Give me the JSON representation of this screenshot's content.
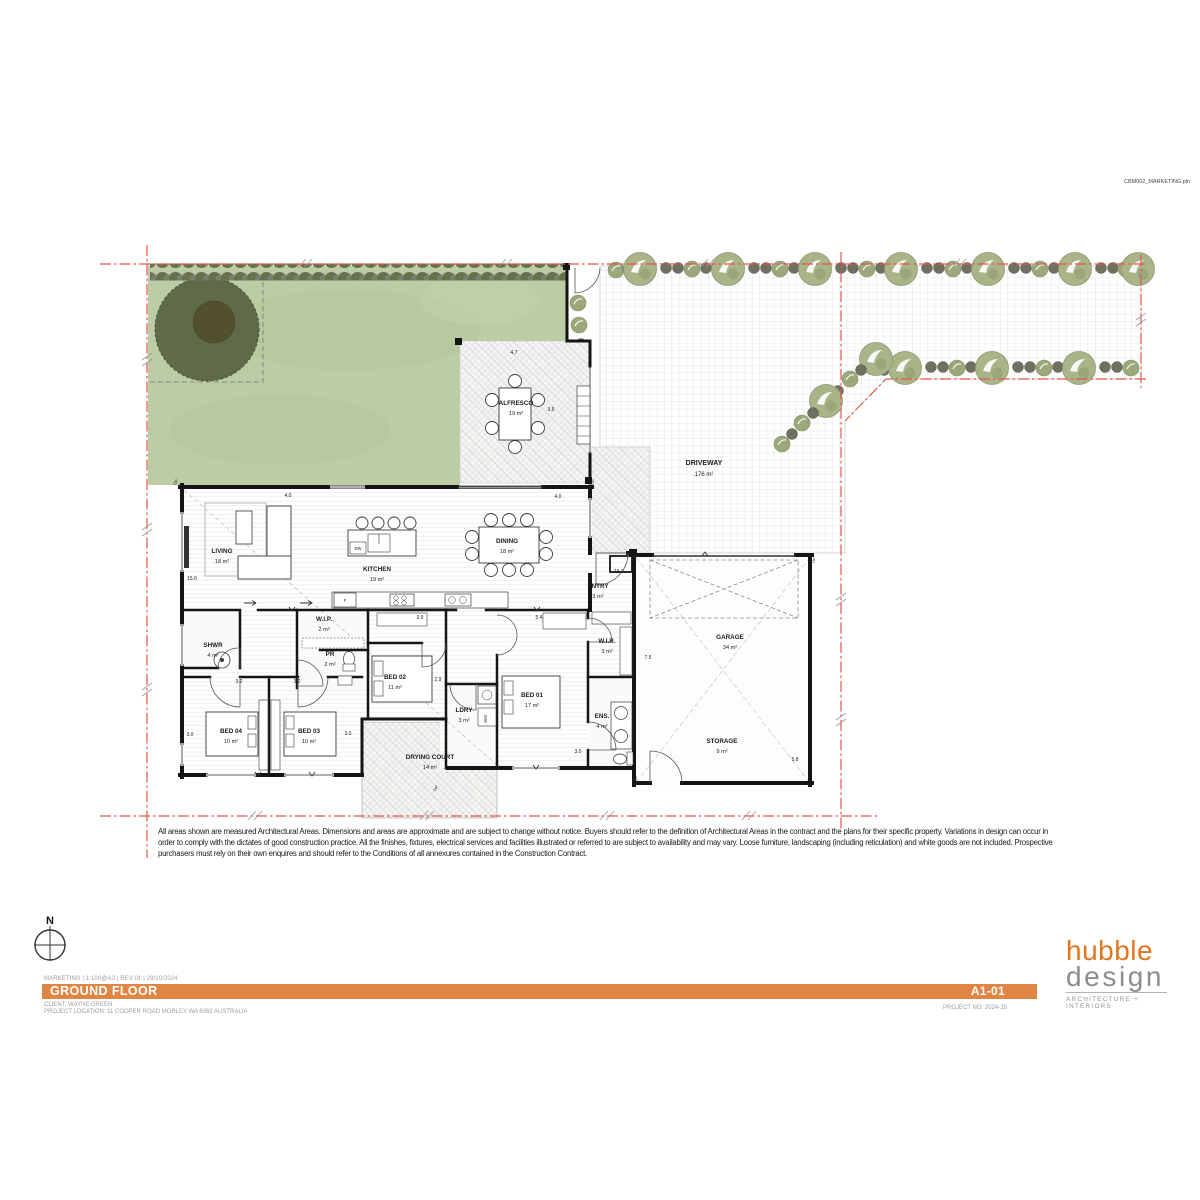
{
  "page": {
    "file_ref": "CBM002_MARKETING.pln"
  },
  "plan": {
    "rooms": [
      {
        "name": "ALFRESCO",
        "area": "19 m²"
      },
      {
        "name": "DRIVEWAY",
        "area": "176 m²"
      },
      {
        "name": "LIVING",
        "area": "18 m²"
      },
      {
        "name": "KITCHEN",
        "area": "19 m²"
      },
      {
        "name": "DINING",
        "area": "18 m²"
      },
      {
        "name": "ENTRY",
        "area": "3 m²"
      },
      {
        "name": "W.I.P.",
        "area": "2 m²"
      },
      {
        "name": "SHWR",
        "area": "4 m²"
      },
      {
        "name": "PR",
        "area": "2 m²"
      },
      {
        "name": "BED 02",
        "area": "11 m²"
      },
      {
        "name": "W.I.R.",
        "area": "3 m²"
      },
      {
        "name": "BED 01",
        "area": "17 m²"
      },
      {
        "name": "LDRY",
        "area": "3 m²"
      },
      {
        "name": "ENS.",
        "area": "4 m²"
      },
      {
        "name": "BED 04",
        "area": "10 m²"
      },
      {
        "name": "BED 03",
        "area": "10 m²"
      },
      {
        "name": "DRYING COURT",
        "area": "14 m²"
      },
      {
        "name": "GARAGE",
        "area": "34 m²"
      },
      {
        "name": "STORAGE",
        "area": "9 m²"
      }
    ],
    "dims": {
      "values": [
        "4.0",
        "4.7",
        "3.6",
        "4.0",
        "15.6",
        "15.6",
        "5.4",
        "3.9",
        "2.9",
        "7.5",
        "3.2",
        "3.2",
        "3.0",
        "3.0",
        "3.0",
        "5.8"
      ]
    },
    "fixtures": {
      "dishwasher": "DW",
      "fridge": "F",
      "washing_machine": "WM",
      "downpipe": "DP"
    },
    "colors": {
      "boundary_red": "#e2574c",
      "lawn_green": "#bccca4",
      "accent_orange": "#e08543",
      "logo_orange": "#e2761e",
      "logo_gray": "#8d8d8d"
    }
  },
  "compass": {
    "north": "N"
  },
  "disclaimer": {
    "line1": "All areas shown are measured Architectural Areas. Dimensions and areas are approximate and are subject to change without notice. Buyers should refer to the definition of Architectural Areas in the contract and the plans for their specific property. Variations in design can occur in",
    "line2": "order to comply with the dictates of good construction practice. All the finishes, fixtures, electrical services and facilities illustrated or referred to are subject to availability and may vary. Loose furniture, landscaping (including reticulation) and white goods are not included. Prospective",
    "line3": "purchasers must rely on their own enquires and should refer to the Conditions of all annexures contained in the Construction Contract."
  },
  "titleblock": {
    "meta": "MARKETING | 1:100@A3 | REV 01 | 29/10/2024",
    "title": "GROUND FLOOR",
    "sheet": "A1-01",
    "client": "CLIENT: WAYNE GREEN",
    "location": "PROJECT LOCATION: 11 COOPER ROAD MORLEY WA 6062 AUSTRALIA",
    "project_no": "PROJECT NO: 2024-35"
  },
  "logo": {
    "word1": "hubble",
    "word2": "design",
    "tagline": "ARCHITECTURE + INTERIORS"
  }
}
